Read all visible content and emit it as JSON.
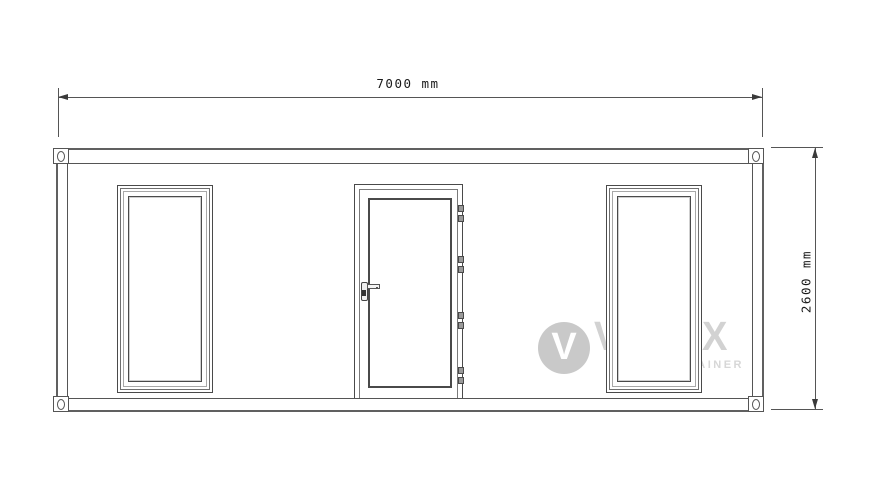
{
  "drawing": {
    "type": "container-front-elevation",
    "dimensions": {
      "width_label": "7000 mm",
      "height_label": "2600 mm"
    },
    "watermark": {
      "logo_letter": "V",
      "brand": "VILLEX",
      "subtitle": "CONTAINER"
    },
    "structure": {
      "corner_castings": 4,
      "windows": 2,
      "doors": 1,
      "door_hinges": 4
    },
    "colors": {
      "background": "#ffffff",
      "line": "#4a4a4a",
      "dimension_line": "#555555",
      "dimension_text": "#1a1a1a",
      "watermark_text": "#d2d2d2",
      "watermark_circle": "#c9c9c9"
    }
  }
}
